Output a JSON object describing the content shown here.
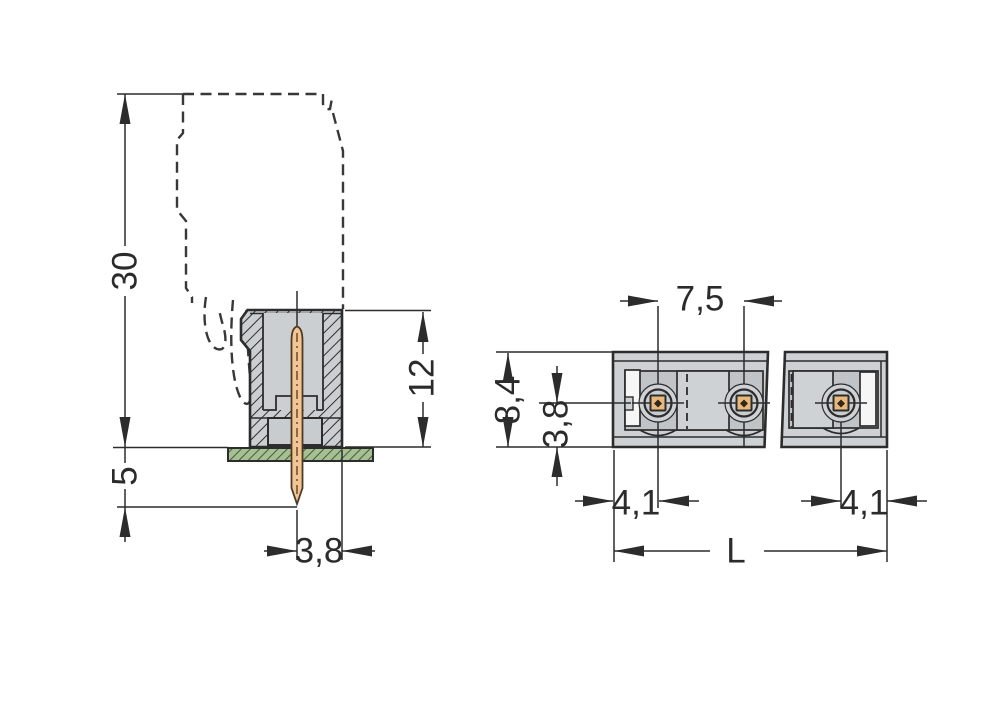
{
  "drawing": {
    "dimensions": {
      "side_total_height": "30",
      "side_pin_protrusion": "5",
      "side_body_height": "12",
      "side_pin_to_edge": "3,8",
      "top_pin_pitch": "7,5",
      "top_body_depth": "8,4",
      "top_pin_to_edge": "3,8",
      "top_end_offset_left": "4,1",
      "top_end_offset_right": "4,1",
      "top_total_length": "L"
    },
    "colors": {
      "line": "#2c2c2c",
      "body_gray": "#cdd1d4",
      "cavity_gray": "#c0c4c7",
      "block_gray": "#ced2d5",
      "pin_copper": "#f2c694",
      "pin_pad_orange": "#eab87a",
      "pcb_green": "#a6c094",
      "pcb_hatch_green": "#44603a",
      "background": "#ffffff"
    }
  }
}
